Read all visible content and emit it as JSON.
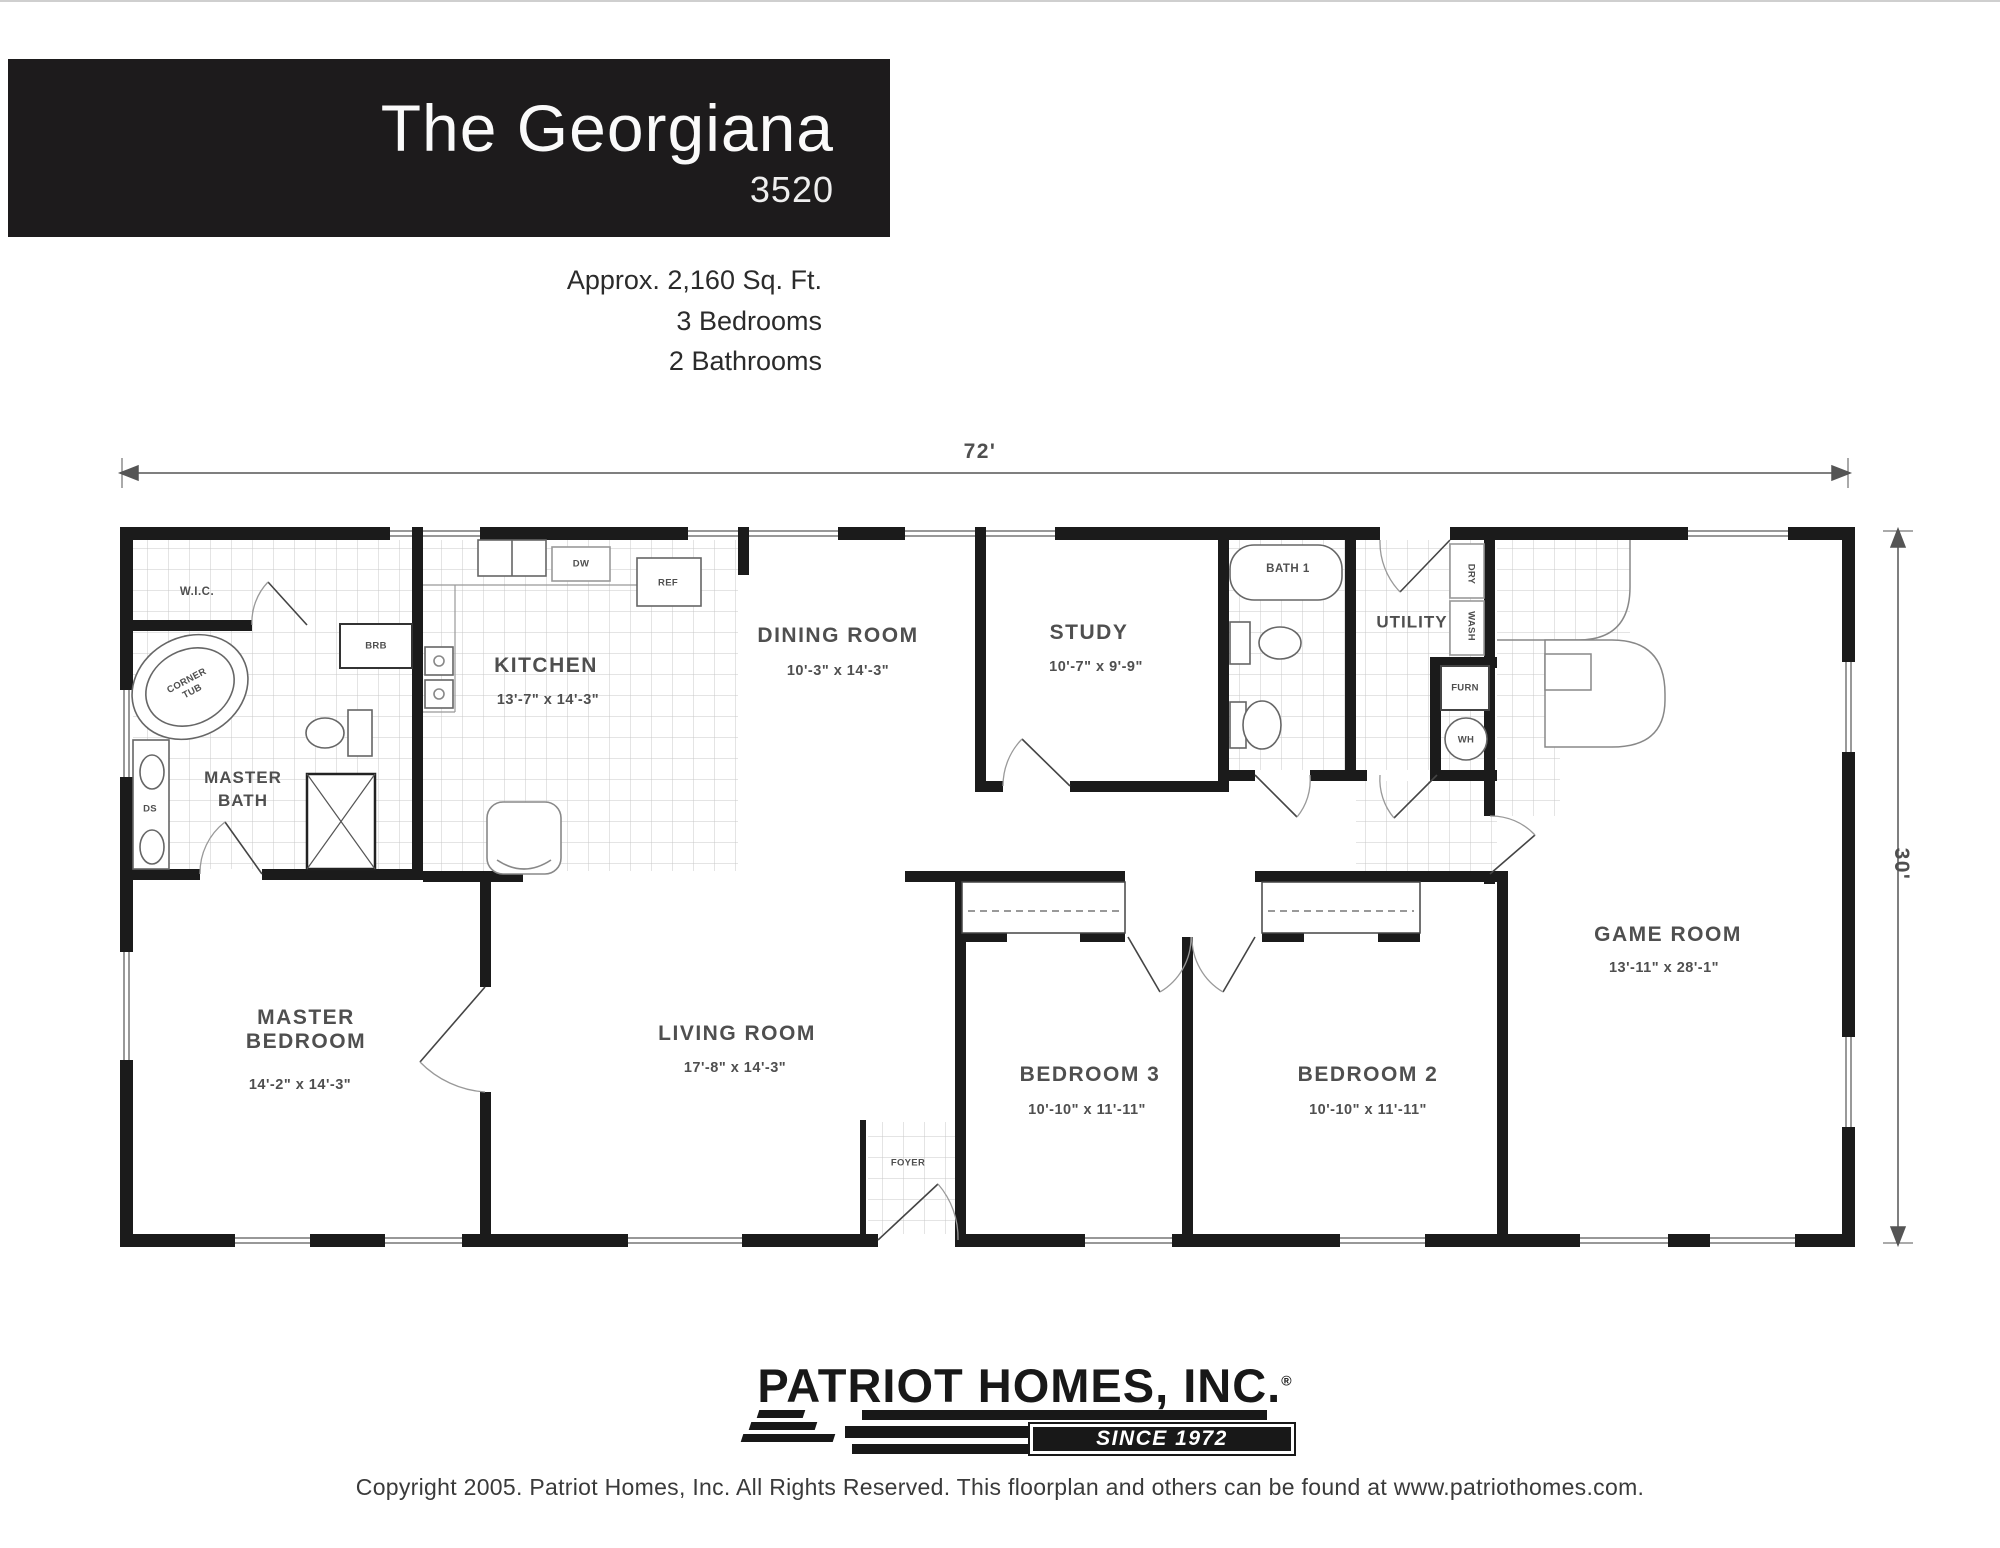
{
  "header": {
    "title": "The Georgiana",
    "model": "3520",
    "approx_area": "Approx. 2,160 Sq. Ft.",
    "bedrooms": "3 Bedrooms",
    "bathrooms": "2 Bathrooms"
  },
  "dimensions": {
    "overall_width": "72'",
    "overall_depth": "30'"
  },
  "rooms": {
    "master_bath": {
      "line1": "MASTER",
      "line2": "BATH"
    },
    "wic": {
      "name": "W.I.C."
    },
    "kitchen": {
      "name": "KITCHEN",
      "dims": "13'-7\" x 14'-3\""
    },
    "dining_room": {
      "name": "DINING ROOM",
      "dims": "10'-3\" x 14'-3\""
    },
    "study": {
      "name": "STUDY",
      "dims": "10'-7\" x 9'-9\""
    },
    "bath1": {
      "name": "BATH 1"
    },
    "utility": {
      "name": "UTILITY"
    },
    "game_room": {
      "name": "GAME ROOM",
      "dims": "13'-11\" x 28'-1\""
    },
    "master_bedroom": {
      "line1": "MASTER",
      "line2": "BEDROOM",
      "dims": "14'-2\" x 14'-3\""
    },
    "living_room": {
      "name": "LIVING ROOM",
      "dims": "17'-8\" x 14'-3\""
    },
    "bedroom3": {
      "name": "BEDROOM 3",
      "dims": "10'-10\" x 11'-11\""
    },
    "bedroom2": {
      "name": "BEDROOM 2",
      "dims": "10'-10\" x 11'-11\""
    },
    "foyer": {
      "name": "FOYER"
    }
  },
  "fixtures": {
    "corner_tub_line1": "CORNER",
    "corner_tub_line2": "TUB",
    "dw": "DW",
    "ref": "REF",
    "brb": "BRB",
    "ds": "DS",
    "wash": "WASH",
    "dry": "DRY",
    "furn": "FURN",
    "wh": "WH"
  },
  "branding": {
    "company": "PATRIOT HOMES, INC.",
    "registered": "®",
    "since": "SINCE 1972"
  },
  "footer": {
    "copyright": "Copyright 2005.  Patriot Homes, Inc.  All Rights Reserved.  This floorplan and others can be found at www.patriothomes.com."
  }
}
